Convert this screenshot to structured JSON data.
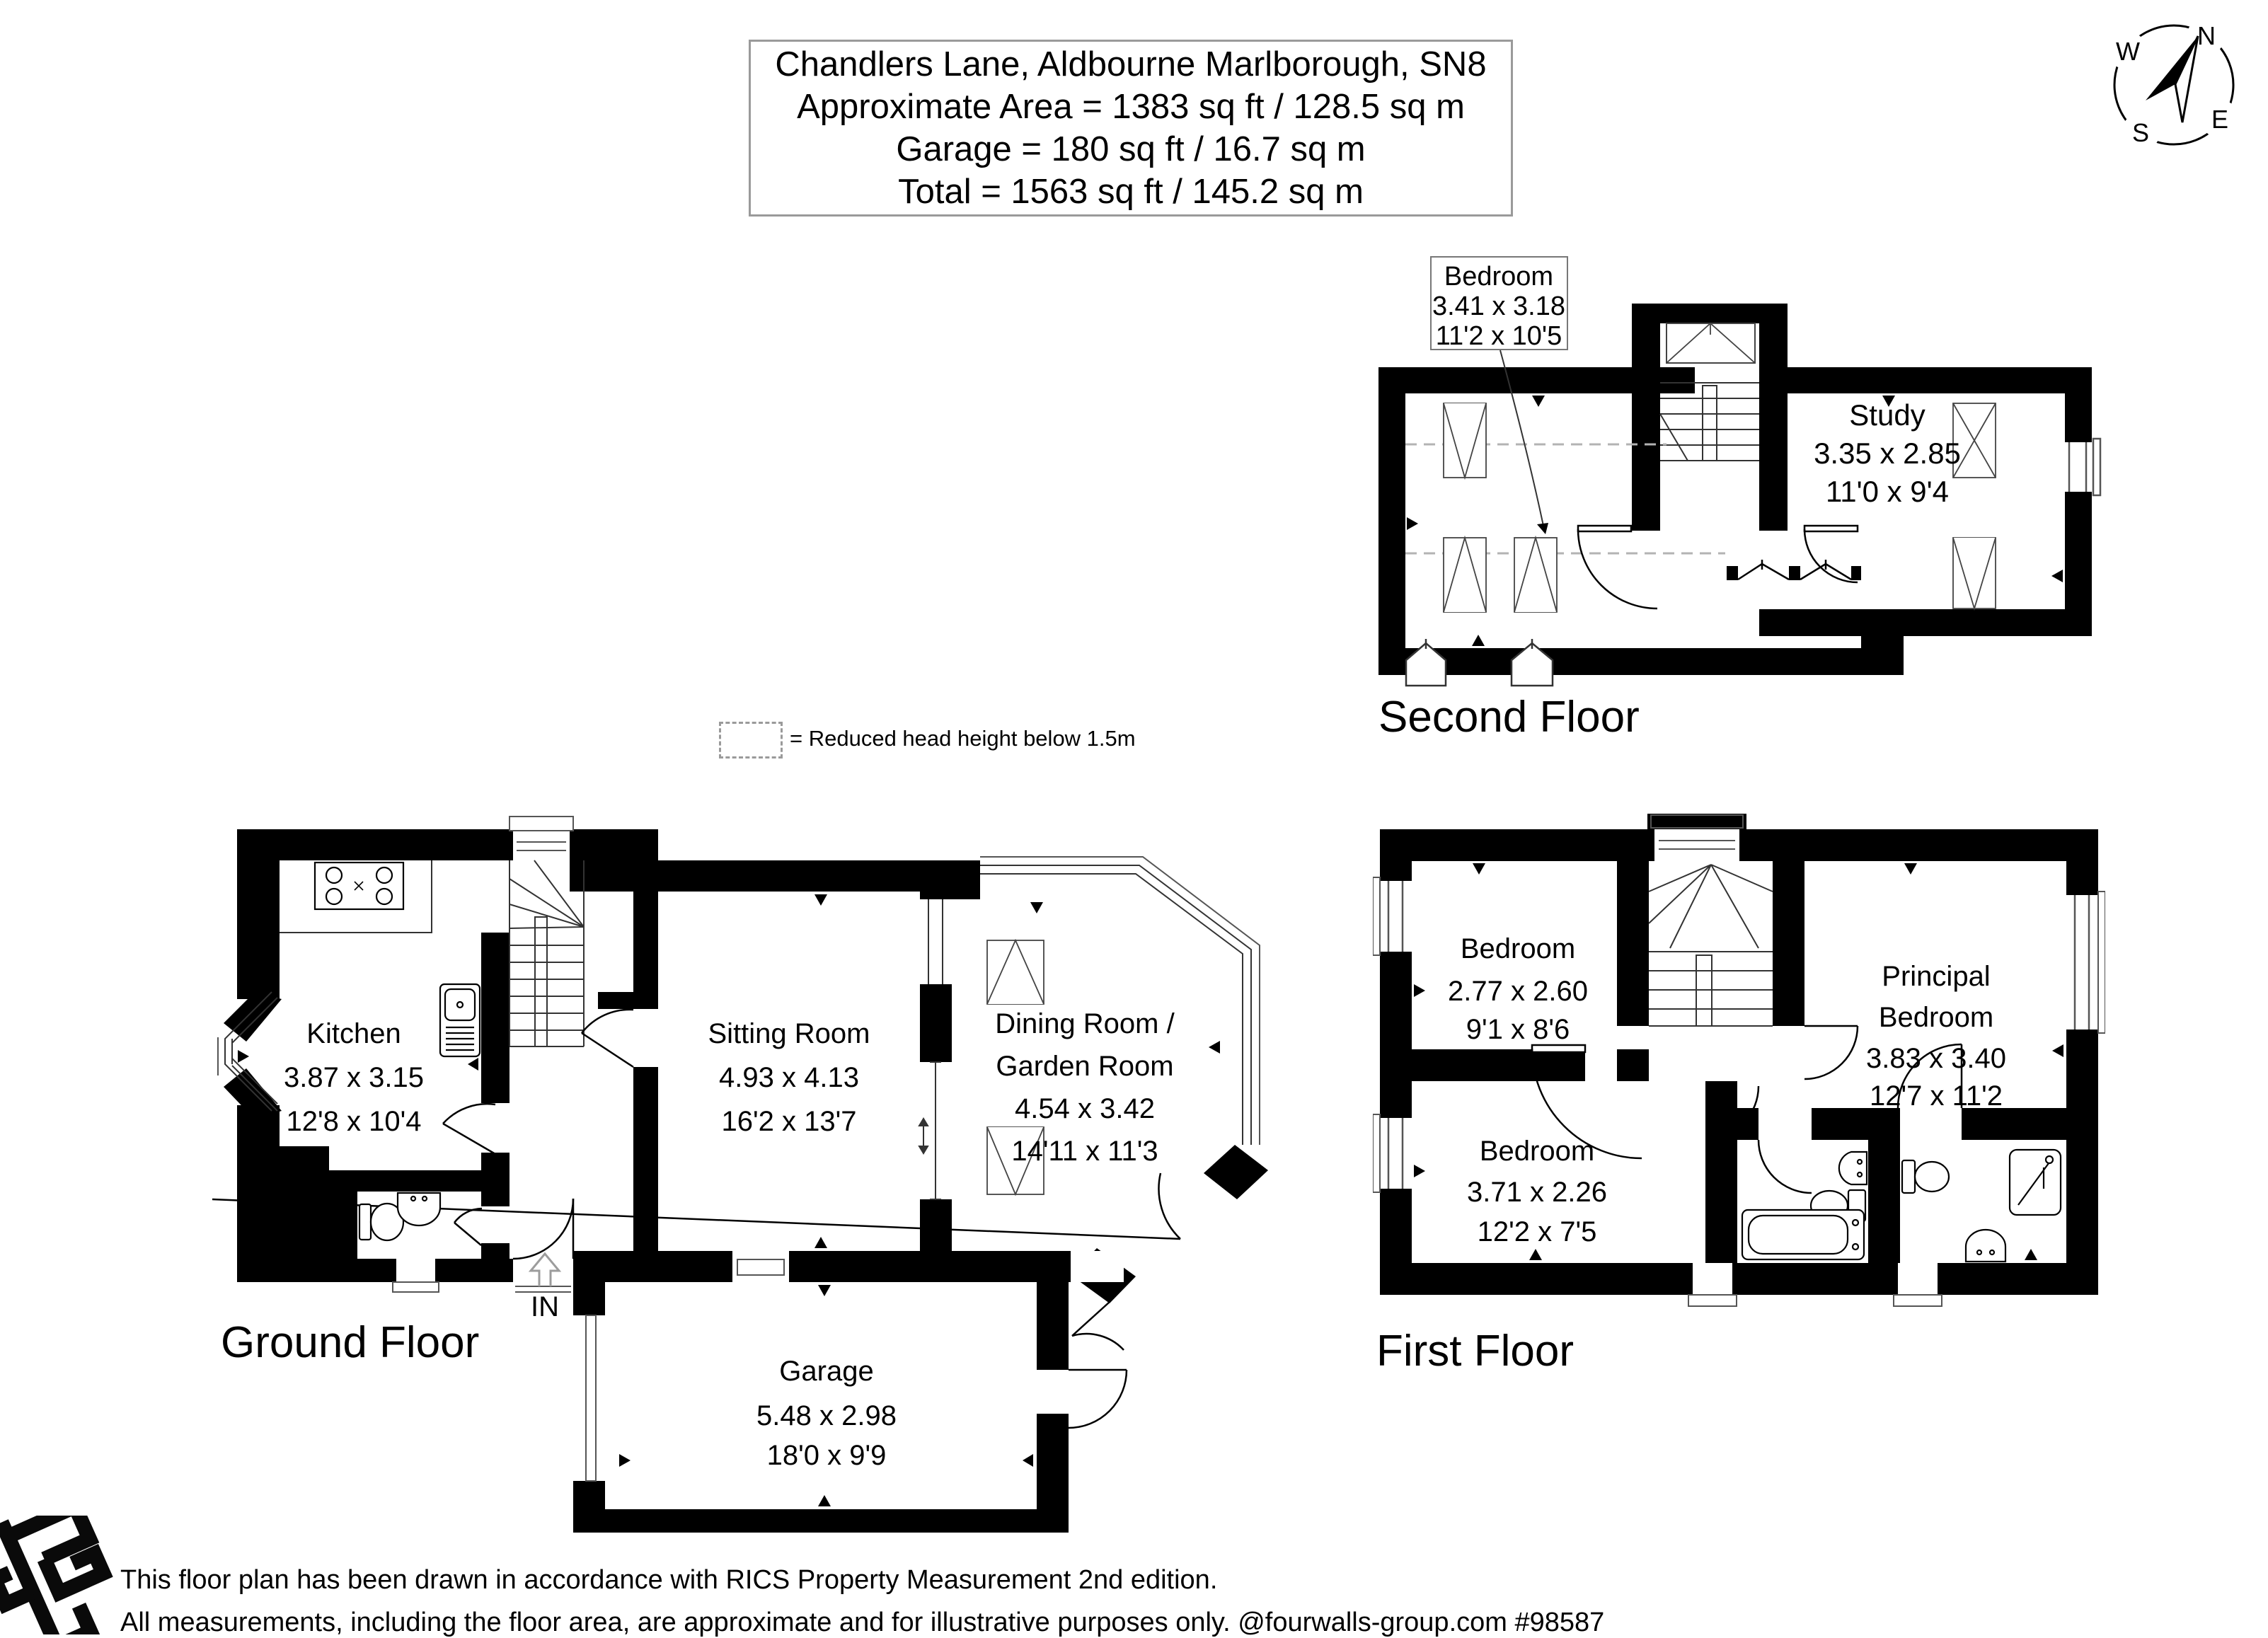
{
  "title": {
    "address": "Chandlers Lane, Aldbourne Marlborough, SN8",
    "area": "Approximate Area = 1383 sq ft / 128.5 sq m",
    "garage": "Garage = 180 sq ft / 16.7 sq m",
    "total": "Total = 1563 sq ft / 145.2 sq m"
  },
  "compass": {
    "n": "N",
    "e": "E",
    "s": "S",
    "w": "W"
  },
  "legend": {
    "text": "= Reduced head height below 1.5m"
  },
  "floors": {
    "second": {
      "label": "Second Floor",
      "bedroom": {
        "name": "Bedroom",
        "metric": "3.41 x 3.18",
        "imperial": "11'2 x 10'5"
      },
      "study": {
        "name": "Study",
        "metric": "3.35 x 2.85",
        "imperial": "11'0 x 9'4"
      }
    },
    "ground": {
      "label": "Ground Floor",
      "in_label": "IN",
      "kitchen": {
        "name": "Kitchen",
        "metric": "3.87 x 3.15",
        "imperial": "12'8 x 10'4"
      },
      "sitting": {
        "name": "Sitting Room",
        "metric": "4.93 x 4.13",
        "imperial": "16'2 x 13'7"
      },
      "dining": {
        "name_line1": "Dining Room /",
        "name_line2": "Garden Room",
        "metric": "4.54 x 3.42",
        "imperial": "14'11 x 11'3"
      },
      "garage": {
        "name": "Garage",
        "metric": "5.48 x 2.98",
        "imperial": "18'0 x 9'9"
      }
    },
    "first": {
      "label": "First Floor",
      "bedroom1": {
        "name": "Bedroom",
        "metric": "2.77 x 2.60",
        "imperial": "9'1 x 8'6"
      },
      "principal": {
        "name_line1": "Principal",
        "name_line2": "Bedroom",
        "metric": "3.83 x 3.40",
        "imperial": "12'7 x 11'2"
      },
      "bedroom2": {
        "name": "Bedroom",
        "metric": "3.71 x 2.26",
        "imperial": "12'2 x 7'5"
      }
    }
  },
  "footer": {
    "line1": "This floor plan has been drawn in accordance with RICS Property Measurement 2nd edition.",
    "line2": "All measurements, including the floor area, are approximate and for illustrative purposes only. @fourwalls-group.com #98587"
  }
}
